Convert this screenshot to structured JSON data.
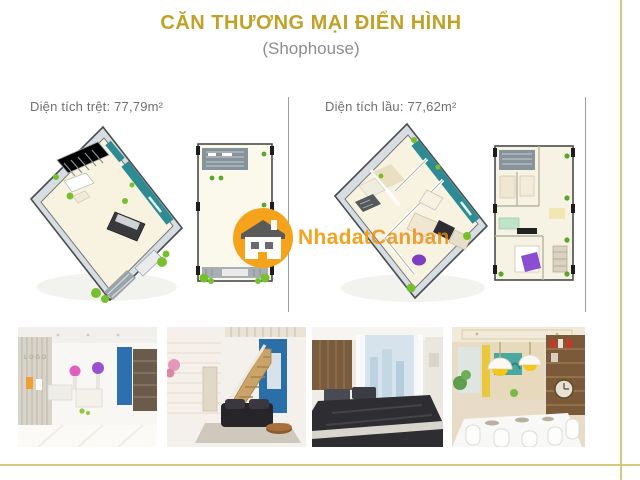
{
  "page": {
    "title": "CĂN THƯƠNG MẠI ĐIỂN HÌNH",
    "subtitle": "(Shophouse)"
  },
  "floor_sections": [
    {
      "name": "ground-floor",
      "area_label": "Diện tích trệt: 77,79m²"
    },
    {
      "name": "upper-floor",
      "area_label": "Diện tích lầu: 77,62m²"
    }
  ],
  "watermark": {
    "logo": "house-icon",
    "brand_first": "Nhadat",
    "brand_second": "Canban"
  },
  "photos": [
    {
      "name": "shop-interior",
      "wall_text": "LOGO"
    },
    {
      "name": "living-room-with-stairs"
    },
    {
      "name": "bedroom"
    },
    {
      "name": "dining-room"
    }
  ],
  "colors": {
    "title_gold": "#c2a127",
    "subtitle_gray": "#8d8d8d",
    "label_gray": "#6f6f6f",
    "frame_gold": "#d5c87a",
    "divider_gray": "#9aa0a2",
    "watermark_orange": "#f39e14",
    "plan_teal": "#2f8b93",
    "plan_floor_cream": "#f8f3e0",
    "plan_wall_gray": "#d7dde0",
    "plant_green": "#76c02e"
  }
}
